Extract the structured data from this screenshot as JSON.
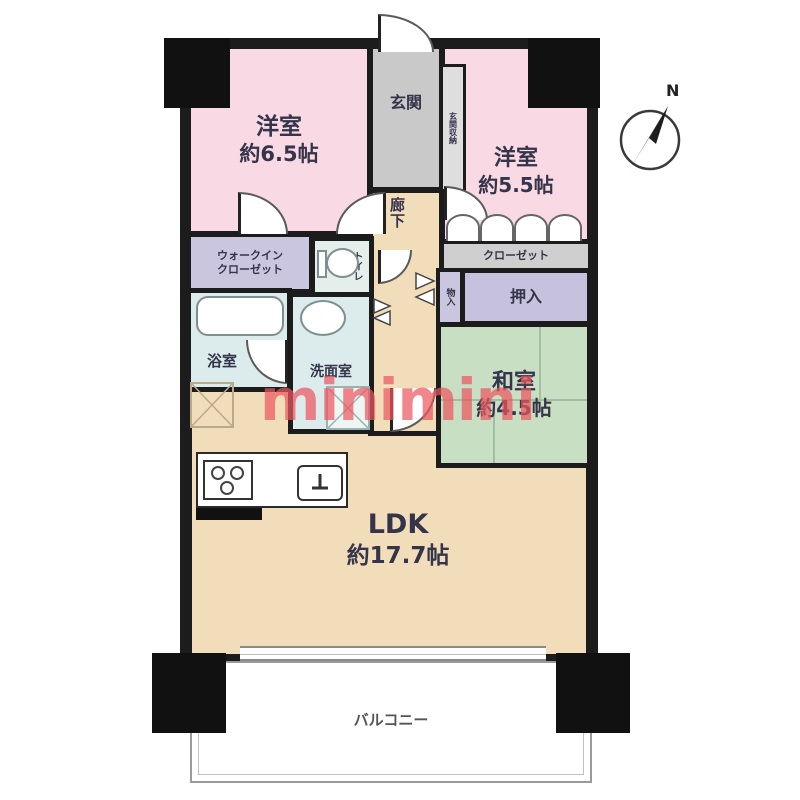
{
  "watermark": {
    "text": "minimini",
    "color": "#ec5860"
  },
  "compass": {
    "label": "N"
  },
  "rooms": {
    "western1": {
      "name": "洋室",
      "size": "約6.5帖"
    },
    "western2": {
      "name": "洋室",
      "size": "約5.5帖"
    },
    "japanese": {
      "name": "和室",
      "size": "約4.5帖"
    },
    "ldk": {
      "name": "LDK",
      "size": "約17.7帖"
    },
    "entrance": {
      "label": "玄関"
    },
    "entrance_storage": {
      "label": "玄関収納"
    },
    "hallway": {
      "label": "廊下"
    },
    "walk_in_closet": {
      "line1": "ウォークイン",
      "line2": "クローゼット"
    },
    "toilet": {
      "label": "トイレ"
    },
    "bathroom": {
      "label": "浴室"
    },
    "washroom": {
      "label": "洗面室"
    },
    "closet": {
      "label": "クローゼット"
    },
    "oshiire": {
      "label": "押入"
    },
    "storage": {
      "label": "物入"
    },
    "balcony": {
      "label": "バルコニー"
    }
  },
  "colors": {
    "wall": "#1c1c1c",
    "western_room_pink": "#f9d9e3",
    "wood_floor_tan": "#f2ddbb",
    "japanese_room_green": "#c8dfc3",
    "closet_lavender": "#cbc6e0",
    "entrance_gray": "#c9c9c9",
    "closet_gray": "#cfcfcf",
    "wet_area_blue": "#dcecec",
    "watermark_red": "#ec5860"
  }
}
